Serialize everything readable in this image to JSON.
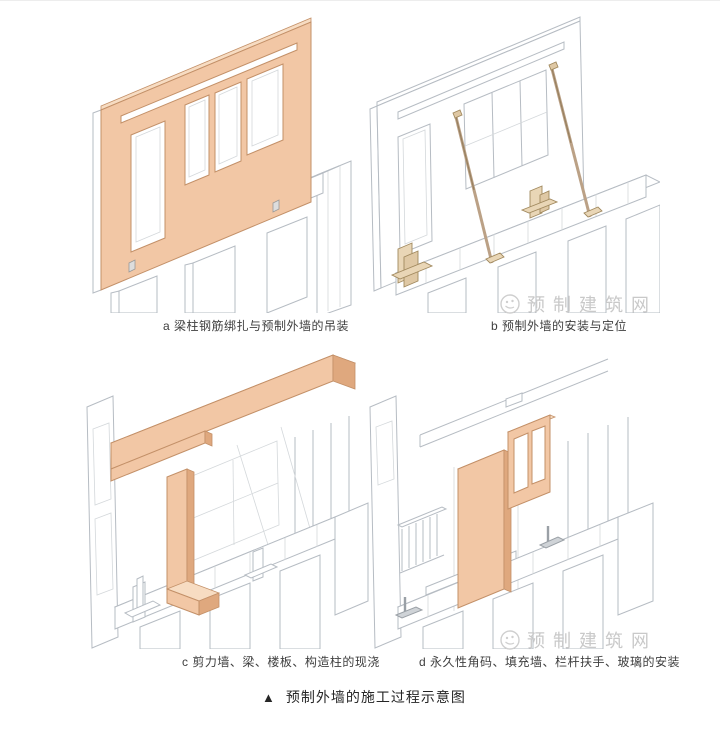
{
  "figure": {
    "panels": [
      {
        "id": "a",
        "label": "a 梁柱钢筋绑扎与预制外墙的吊装"
      },
      {
        "id": "b",
        "label": "b 预制外墙的安装与定位"
      },
      {
        "id": "c",
        "label": "c 剪力墙、梁、楼板、构造柱的现浇"
      },
      {
        "id": "d",
        "label": "d 永久性角码、填充墙、栏杆扶手、玻璃的安装"
      }
    ],
    "title": {
      "marker": "▲",
      "text": "预制外墙的施工过程示意图"
    },
    "watermark": {
      "text": "预制建筑网"
    },
    "colors": {
      "precast": "#f2c7a5",
      "precast_top": "#f7dcc2",
      "precast_side": "#dfa87e",
      "precast_edge": "#c39068",
      "line": "#b6bcc3",
      "line_light": "#d4d8db",
      "brace": "#bba186",
      "brace_dark": "#97805f",
      "bracket_fill": "#e9d6b6",
      "bracket_edge": "#a1895e",
      "caption": "#3e3e3e",
      "title": "#262626",
      "watermark": "#c9c9c9"
    }
  }
}
